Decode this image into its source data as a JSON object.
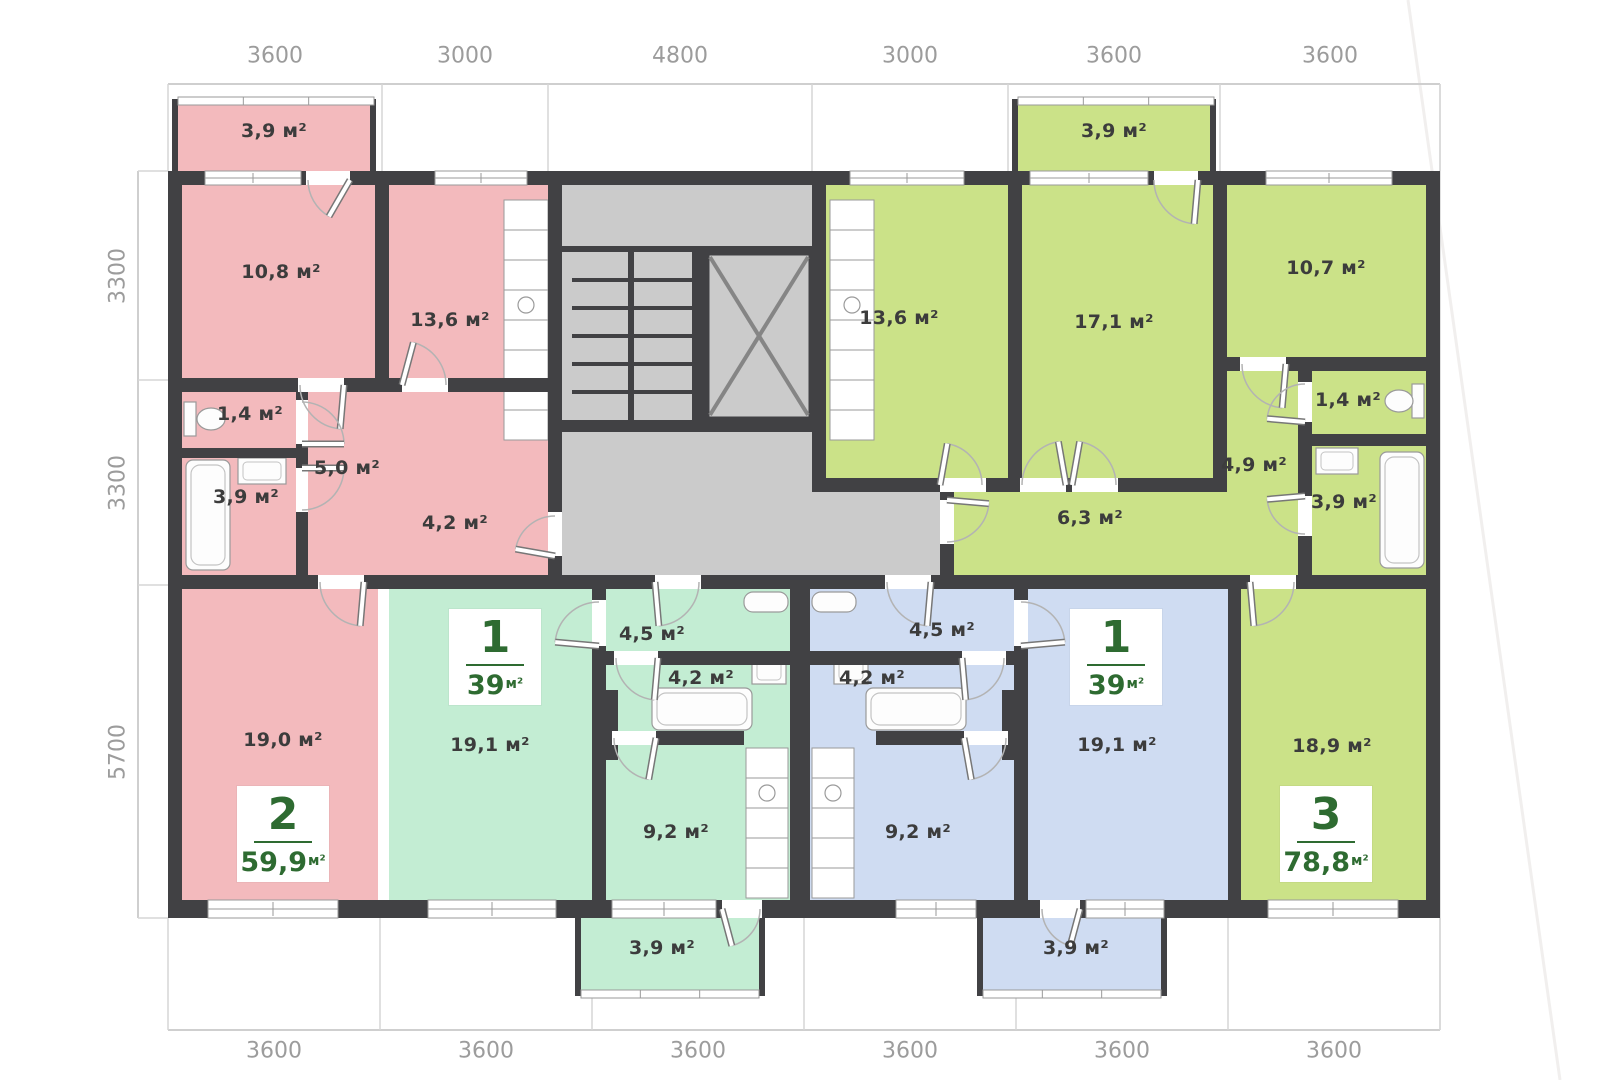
{
  "dimensions": {
    "top": [
      "3600",
      "3000",
      "4800",
      "3000",
      "3600",
      "3600"
    ],
    "left": [
      "3300",
      "3300",
      "5700"
    ],
    "bottom": [
      "3600",
      "3600",
      "3600",
      "3600",
      "3600",
      "3600"
    ]
  },
  "apartments": [
    {
      "name": "two-room-apartment",
      "badge": {
        "number": "2",
        "area": "59,9",
        "unit": "м²"
      },
      "rooms": {
        "balcony": "3,9 м²",
        "bedroom": "10,8 м²",
        "kitchen": "13,6 м²",
        "wc": "1,4 м²",
        "hall": "5,0 м²",
        "bathroom": "3,9 м²",
        "corridor": "4,2 м²",
        "living": "19,0 м²"
      }
    },
    {
      "name": "one-room-apartment-left",
      "badge": {
        "number": "1",
        "area": "39",
        "unit": "м²"
      },
      "rooms": {
        "living": "19,1 м²",
        "hall": "4,5 м²",
        "bathroom": "4,2 м²",
        "kitchen": "9,2 м²",
        "balcony": "3,9 м²"
      }
    },
    {
      "name": "one-room-apartment-right",
      "badge": {
        "number": "1",
        "area": "39",
        "unit": "м²"
      },
      "rooms": {
        "living": "19,1 м²",
        "hall": "4,5 м²",
        "bathroom": "4,2 м²",
        "kitchen": "9,2 м²",
        "balcony": "3,9 м²"
      }
    },
    {
      "name": "three-room-apartment",
      "badge": {
        "number": "3",
        "area": "78,8",
        "unit": "м²"
      },
      "rooms": {
        "balcony": "3,9 м²",
        "kitchen": "13,6 м²",
        "living": "17,1 м²",
        "bedroom": "10,7 м²",
        "wc": "1,4 м²",
        "hall": "4,9 м²",
        "bathroom": "3,9 м²",
        "corridor": "6,3 м²",
        "bedroom2": "18,9 м²"
      }
    }
  ],
  "colors": {
    "wall": "#414144",
    "apartment_pink": "#f3babd",
    "apartment_mint": "#c3edd3",
    "apartment_blue": "#cfdcf2",
    "apartment_green": "#cbe288",
    "common_area": "#cbcbcb",
    "badge_text": "#2e6b31",
    "dimension_text": "#9c9c9c",
    "room_text": "#3c3c3c"
  }
}
